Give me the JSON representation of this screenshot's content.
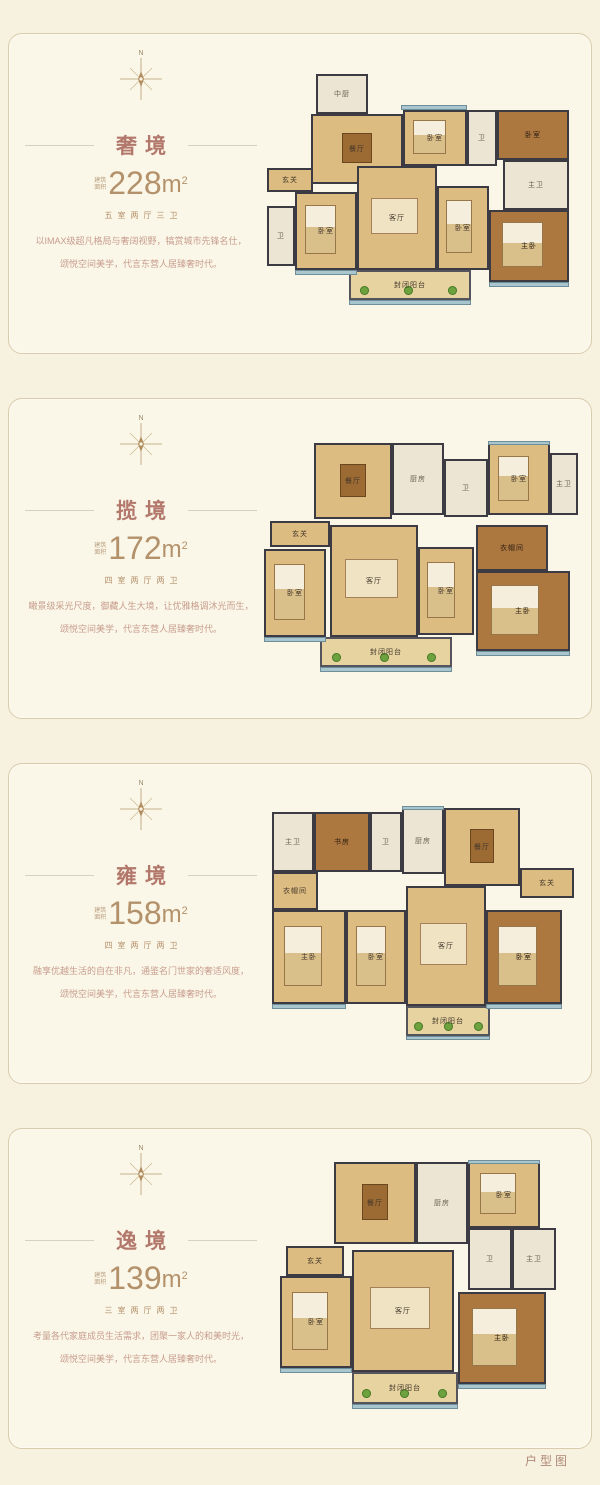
{
  "page": {
    "footer_label": "户型图"
  },
  "compass_label": "N",
  "area_prefix_l1": "建筑",
  "area_prefix_l2": "面积",
  "palette": {
    "page_bg": "#f7f2df",
    "panel_bg": "#fbf7e8",
    "panel_border": "#d9cbab",
    "title_color": "#b3786c",
    "area_color": "#b3916b",
    "desc_color": "#c79d8e",
    "wall_color": "#3c3a42",
    "floor_tan": "#dcbc80",
    "floor_wood": "#ad7740",
    "tile_pale": "#ece5d3",
    "window_teal": "#a9c6ce",
    "plant_green": "#6da23f"
  },
  "panels": [
    {
      "name": "奢境",
      "area_value": "228",
      "area_unit": "m",
      "area_sup": "2",
      "layout": "五室两厅三卫",
      "desc_line1": "以IMAX级超凡格局与奢阔视野，犒赏城市先锋名仕，",
      "desc_line2": "颂悦空间美学，代言东营人居臻奢时代。",
      "plan": {
        "w": 322,
        "h": 240,
        "rooms": [
          {
            "label": "中厨",
            "x": 55,
            "y": 0,
            "w": 52,
            "h": 40,
            "type": "pale"
          },
          {
            "label": "餐厅",
            "x": 50,
            "y": 40,
            "w": 92,
            "h": 70,
            "type": "tan",
            "furn": "table"
          },
          {
            "label": "卧室",
            "x": 142,
            "y": 36,
            "w": 64,
            "h": 56,
            "type": "tan",
            "furn": "bed"
          },
          {
            "label": "卫",
            "x": 206,
            "y": 36,
            "w": 30,
            "h": 56,
            "type": "pale"
          },
          {
            "label": "卧室",
            "x": 236,
            "y": 36,
            "w": 72,
            "h": 50,
            "type": "wood"
          },
          {
            "label": "主卫",
            "x": 242,
            "y": 86,
            "w": 66,
            "h": 50,
            "type": "pale"
          },
          {
            "label": "玄关",
            "x": 6,
            "y": 94,
            "w": 46,
            "h": 24,
            "type": "tan"
          },
          {
            "label": "卫",
            "x": 6,
            "y": 132,
            "w": 28,
            "h": 60,
            "type": "pale"
          },
          {
            "label": "卧室",
            "x": 34,
            "y": 118,
            "w": 62,
            "h": 78,
            "type": "tan",
            "furn": "bed"
          },
          {
            "label": "客厅",
            "x": 96,
            "y": 92,
            "w": 80,
            "h": 104,
            "type": "tan",
            "furn": "sofa"
          },
          {
            "label": "卧室",
            "x": 176,
            "y": 112,
            "w": 52,
            "h": 84,
            "type": "tan",
            "furn": "bed"
          },
          {
            "label": "主卧",
            "x": 228,
            "y": 136,
            "w": 80,
            "h": 72,
            "type": "wood",
            "furn": "bed"
          },
          {
            "label": "封闭阳台",
            "x": 88,
            "y": 196,
            "w": 122,
            "h": 30,
            "type": "balcony",
            "plants": true
          }
        ],
        "windows": [
          {
            "x": 88,
            "y": 226,
            "w": 122,
            "h": 5
          },
          {
            "x": 34,
            "y": 196,
            "w": 62,
            "h": 5
          },
          {
            "x": 228,
            "y": 208,
            "w": 80,
            "h": 5
          },
          {
            "x": 140,
            "y": 31,
            "w": 66,
            "h": 5
          }
        ]
      }
    },
    {
      "name": "揽境",
      "area_value": "172",
      "area_unit": "m",
      "area_sup": "2",
      "layout": "四室两厅两卫",
      "desc_line1": "瞰景级采光尺度，御藏人生大境，让优雅格调沐光而生，",
      "desc_line2": "颂悦空间美学，代言东营人居臻奢时代。",
      "plan": {
        "w": 320,
        "h": 235,
        "rooms": [
          {
            "label": "餐厅",
            "x": 52,
            "y": 2,
            "w": 78,
            "h": 76,
            "type": "tan",
            "furn": "table"
          },
          {
            "label": "厨房",
            "x": 130,
            "y": 2,
            "w": 52,
            "h": 72,
            "type": "pale"
          },
          {
            "label": "卫",
            "x": 182,
            "y": 18,
            "w": 44,
            "h": 58,
            "type": "pale"
          },
          {
            "label": "卧室",
            "x": 226,
            "y": 2,
            "w": 62,
            "h": 72,
            "type": "tan",
            "furn": "bed"
          },
          {
            "label": "主卫",
            "x": 288,
            "y": 12,
            "w": 28,
            "h": 62,
            "type": "pale"
          },
          {
            "label": "玄关",
            "x": 8,
            "y": 80,
            "w": 60,
            "h": 26,
            "type": "tan"
          },
          {
            "label": "卧室",
            "x": 2,
            "y": 108,
            "w": 62,
            "h": 88,
            "type": "tan",
            "furn": "bed"
          },
          {
            "label": "客厅",
            "x": 68,
            "y": 84,
            "w": 88,
            "h": 112,
            "type": "tan",
            "furn": "sofa"
          },
          {
            "label": "卧室",
            "x": 156,
            "y": 106,
            "w": 56,
            "h": 88,
            "type": "tan",
            "furn": "bed"
          },
          {
            "label": "衣帽间",
            "x": 214,
            "y": 84,
            "w": 72,
            "h": 46,
            "type": "wood"
          },
          {
            "label": "主卧",
            "x": 214,
            "y": 130,
            "w": 94,
            "h": 80,
            "type": "wood",
            "furn": "bed"
          },
          {
            "label": "封闭阳台",
            "x": 58,
            "y": 196,
            "w": 132,
            "h": 30,
            "type": "balcony",
            "plants": true
          }
        ],
        "windows": [
          {
            "x": 58,
            "y": 226,
            "w": 132,
            "h": 5
          },
          {
            "x": 2,
            "y": 196,
            "w": 62,
            "h": 5
          },
          {
            "x": 214,
            "y": 210,
            "w": 94,
            "h": 5
          },
          {
            "x": 226,
            "y": 0,
            "w": 62,
            "h": 4
          }
        ]
      }
    },
    {
      "name": "雍境",
      "area_value": "158",
      "area_unit": "m",
      "area_sup": "2",
      "layout": "四室两厅两卫",
      "desc_line1": "融享优越生活的自在非凡，通鉴名门世家的奢适风度，",
      "desc_line2": "颂悦空间美学，代言东营人居臻奢时代。",
      "plan": {
        "w": 312,
        "h": 235,
        "rooms": [
          {
            "label": "主卫",
            "x": 6,
            "y": 6,
            "w": 42,
            "h": 60,
            "type": "pale"
          },
          {
            "label": "书房",
            "x": 48,
            "y": 6,
            "w": 56,
            "h": 60,
            "type": "wood"
          },
          {
            "label": "卫",
            "x": 104,
            "y": 6,
            "w": 32,
            "h": 60,
            "type": "pale"
          },
          {
            "label": "厨房",
            "x": 136,
            "y": 2,
            "w": 42,
            "h": 66,
            "type": "pale"
          },
          {
            "label": "餐厅",
            "x": 178,
            "y": 2,
            "w": 76,
            "h": 78,
            "type": "tan",
            "furn": "table"
          },
          {
            "label": "玄关",
            "x": 254,
            "y": 62,
            "w": 54,
            "h": 30,
            "type": "tan"
          },
          {
            "label": "衣帽间",
            "x": 6,
            "y": 66,
            "w": 46,
            "h": 38,
            "type": "tan"
          },
          {
            "label": "主卧",
            "x": 6,
            "y": 104,
            "w": 74,
            "h": 94,
            "type": "tan",
            "furn": "bed"
          },
          {
            "label": "卧室",
            "x": 80,
            "y": 104,
            "w": 60,
            "h": 94,
            "type": "tan",
            "furn": "bed"
          },
          {
            "label": "客厅",
            "x": 140,
            "y": 80,
            "w": 80,
            "h": 120,
            "type": "tan",
            "furn": "sofa"
          },
          {
            "label": "卧室",
            "x": 220,
            "y": 104,
            "w": 76,
            "h": 94,
            "type": "wood",
            "furn": "bed"
          },
          {
            "label": "封闭阳台",
            "x": 140,
            "y": 200,
            "w": 84,
            "h": 30,
            "type": "balcony",
            "plants": true
          }
        ],
        "windows": [
          {
            "x": 140,
            "y": 230,
            "w": 84,
            "h": 4
          },
          {
            "x": 6,
            "y": 198,
            "w": 74,
            "h": 5
          },
          {
            "x": 220,
            "y": 198,
            "w": 76,
            "h": 5
          },
          {
            "x": 136,
            "y": 0,
            "w": 42,
            "h": 4
          }
        ]
      }
    },
    {
      "name": "逸境",
      "area_value": "139",
      "area_unit": "m",
      "area_sup": "2",
      "layout": "三室两厅两卫",
      "desc_line1": "考量各代家庭成员生活需求，团聚一家人的和美时光，",
      "desc_line2": "颂悦空间美学，代言东营人居臻奢时代。",
      "plan": {
        "w": 300,
        "h": 258,
        "rooms": [
          {
            "label": "餐厅",
            "x": 62,
            "y": 2,
            "w": 82,
            "h": 82,
            "type": "tan",
            "furn": "table"
          },
          {
            "label": "厨房",
            "x": 144,
            "y": 2,
            "w": 52,
            "h": 82,
            "type": "pale"
          },
          {
            "label": "卧室",
            "x": 196,
            "y": 2,
            "w": 72,
            "h": 66,
            "type": "tan",
            "furn": "bed"
          },
          {
            "label": "卫",
            "x": 196,
            "y": 68,
            "w": 44,
            "h": 62,
            "type": "pale"
          },
          {
            "label": "主卫",
            "x": 240,
            "y": 68,
            "w": 44,
            "h": 62,
            "type": "pale"
          },
          {
            "label": "玄关",
            "x": 14,
            "y": 86,
            "w": 58,
            "h": 30,
            "type": "tan"
          },
          {
            "label": "卧室",
            "x": 8,
            "y": 116,
            "w": 72,
            "h": 92,
            "type": "tan",
            "furn": "bed"
          },
          {
            "label": "客厅",
            "x": 80,
            "y": 90,
            "w": 102,
            "h": 122,
            "type": "tan",
            "furn": "sofa"
          },
          {
            "label": "主卧",
            "x": 186,
            "y": 132,
            "w": 88,
            "h": 92,
            "type": "wood",
            "furn": "bed"
          },
          {
            "label": "封闭阳台",
            "x": 80,
            "y": 212,
            "w": 106,
            "h": 32,
            "type": "balcony",
            "plants": true
          }
        ],
        "windows": [
          {
            "x": 80,
            "y": 244,
            "w": 106,
            "h": 5
          },
          {
            "x": 8,
            "y": 208,
            "w": 72,
            "h": 5
          },
          {
            "x": 186,
            "y": 224,
            "w": 88,
            "h": 5
          },
          {
            "x": 196,
            "y": 0,
            "w": 72,
            "h": 4
          }
        ]
      }
    }
  ]
}
